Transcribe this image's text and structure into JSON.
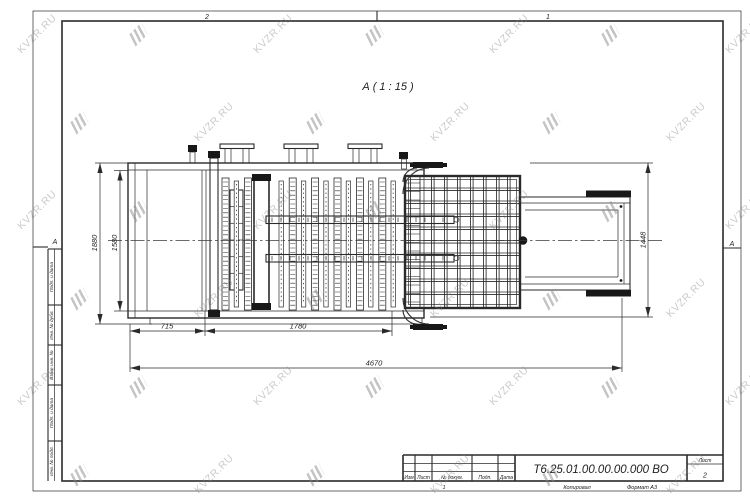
{
  "watermark": {
    "text": "KVZR.RU"
  },
  "sheet": {
    "zone_top_left": "2",
    "zone_top_right": "1",
    "zone_bottom": "1",
    "fold_mark_left": "А",
    "fold_mark_right": "А"
  },
  "view": {
    "label": "А ( 1 : 15 )"
  },
  "dimensions": {
    "height_outer": "1880",
    "height_inner": "1580",
    "height_right": "1448",
    "width_left": "715",
    "width_mid": "1780",
    "width_total": "4670"
  },
  "title_block": {
    "doc_number": "Т6.25.01.00.00.00.000 ВО",
    "sheet_label": "Лист",
    "sheet_number": "2",
    "col_izm": "Изм",
    "col_list": "Лист",
    "col_doc": "№ докум.",
    "col_podp": "Подп.",
    "col_data": "Дата",
    "copied_label": "Копировал",
    "format_label": "Формат А3"
  },
  "side_column": {
    "items": [
      "Подп. и дата",
      "Инв. № дубл.",
      "Взам. инв. №",
      "Подп. и дата",
      "Инв. № подл."
    ]
  }
}
